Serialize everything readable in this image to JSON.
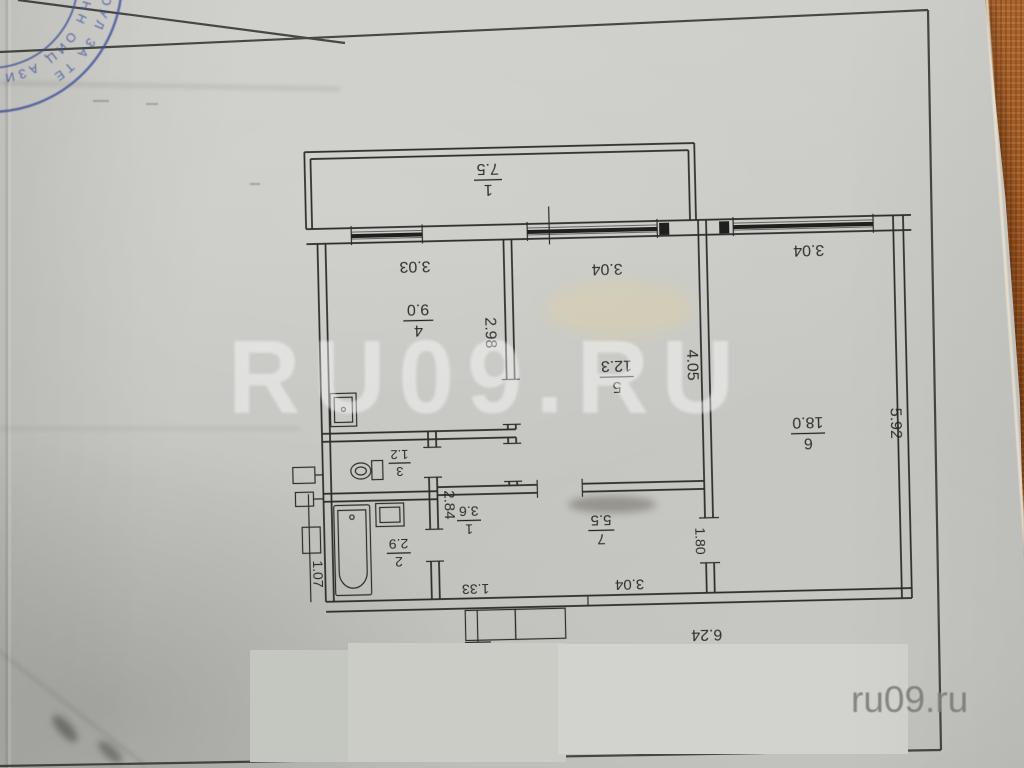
{
  "wm": {
    "center": "RU09.RU",
    "corner": "ru09.ru"
  },
  "stamp": {
    "arc_text_a": "ОУЛ ЗА ТЕ",
    "arc_text_b": "ОНН ОИЦ АЗИ НАГ РО"
  },
  "plan": {
    "rooms": {
      "balcony": {
        "num": "1",
        "area": "7.5"
      },
      "kitchen": {
        "num": "4",
        "area": "9.0"
      },
      "room5": {
        "num": "5",
        "area": "12.3"
      },
      "room6": {
        "num": "6",
        "area": "18.0"
      },
      "wc": {
        "num": "3",
        "area": "1.2"
      },
      "bath": {
        "num": "2",
        "area": "2.9"
      },
      "hall": {
        "num": "1",
        "area": "3.6"
      },
      "room7": {
        "num": "7",
        "area": "5.5"
      }
    },
    "dims": {
      "kitchen_w": "3.03",
      "kitchen_h": "2.98",
      "room5_w": "3.04",
      "room5_h": "4.05",
      "room6_w": "3.04",
      "room6_h": "5.92",
      "hall_h": "2.84",
      "door7": "1.80",
      "room7_w": "3.04",
      "entry": "1.33",
      "bottom": "6.24",
      "left": "1.07"
    }
  },
  "colors": {
    "stamp_blue": "#41529c",
    "fabric": "#a65a22",
    "paper": "#c6c6c2"
  }
}
